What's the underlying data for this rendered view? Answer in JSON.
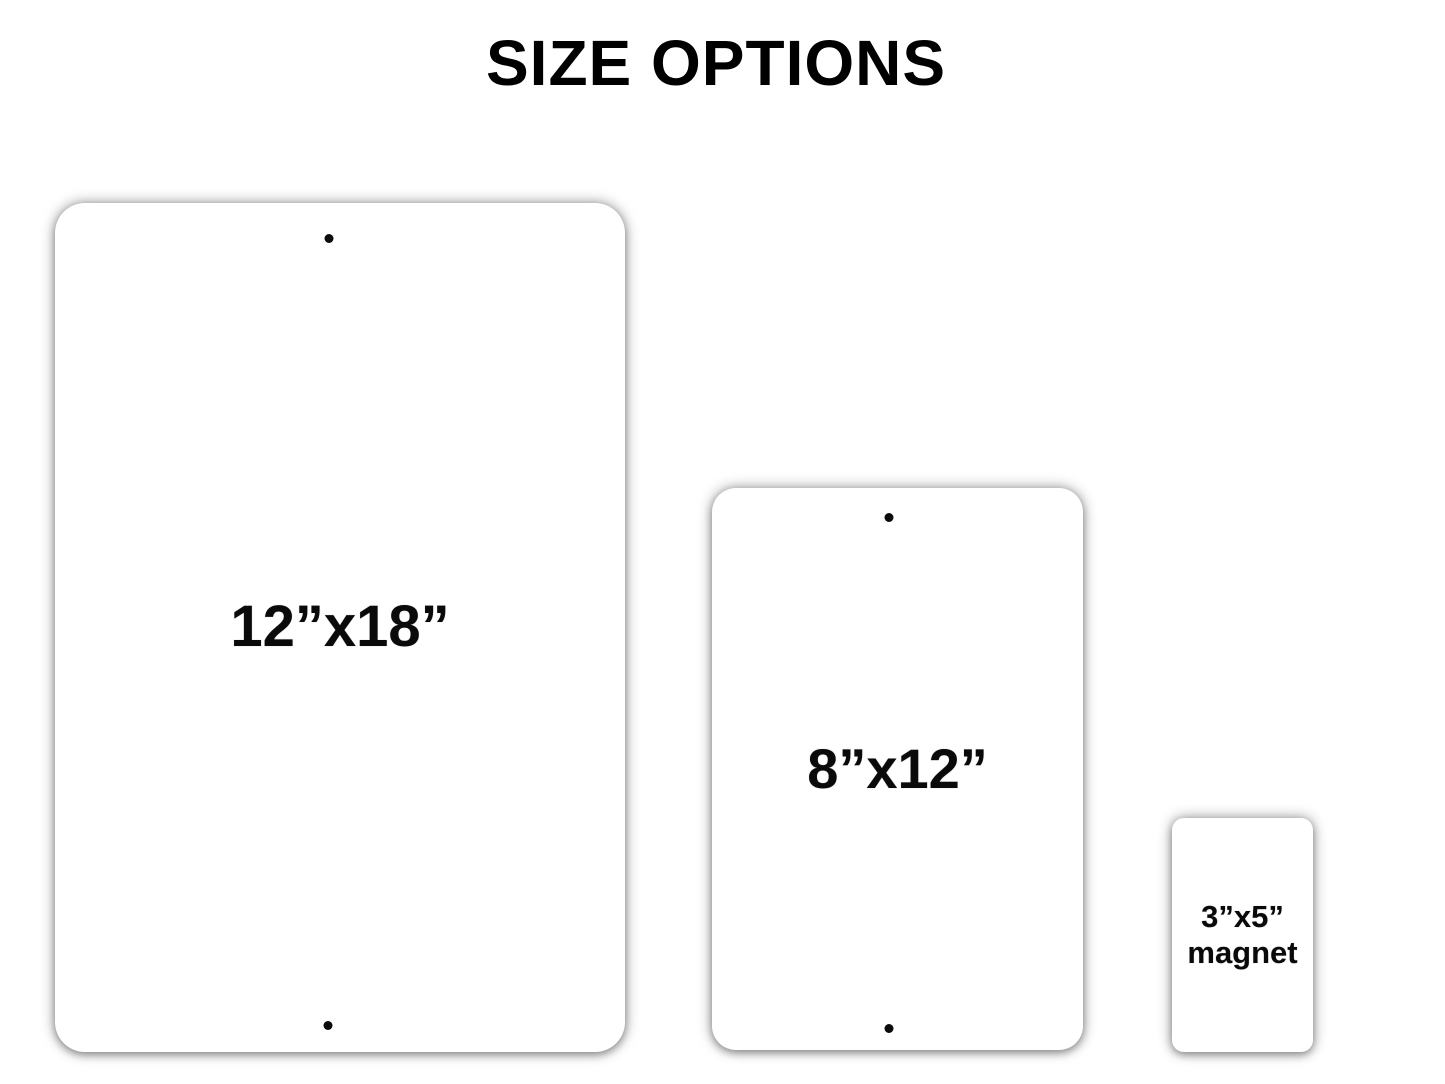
{
  "title": "SIZE OPTIONS",
  "colors": {
    "background": "#ffffff",
    "card": "#ffffff",
    "text": "#000000",
    "shadow": "#9a9a9a"
  },
  "options": [
    {
      "id": "sign-12x18",
      "label": "12”x18”",
      "mounting_holes": 2
    },
    {
      "id": "sign-8x12",
      "label": "8”x12”",
      "mounting_holes": 2
    },
    {
      "id": "magnet-3x5",
      "label_line1": "3”x5”",
      "label_line2": "magnet",
      "mounting_holes": 0
    }
  ]
}
